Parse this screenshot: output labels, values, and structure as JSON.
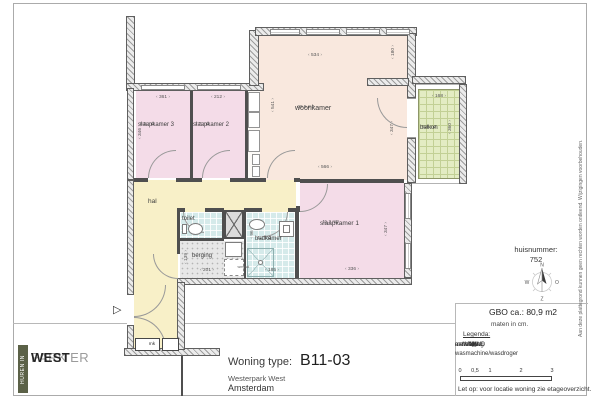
{
  "plan": {
    "rooms": {
      "woonkamer": {
        "label": "woonkamer",
        "area": "29.5 m2"
      },
      "slaapkamer1": {
        "label": "slaapkamer 1",
        "area": "11.2 m2"
      },
      "slaapkamer2": {
        "label": "slaapkamer 2",
        "area": "7.7 m2"
      },
      "slaapkamer3": {
        "label": "slaapkamer 3",
        "area": "8.5 m2"
      },
      "badkamer": {
        "label": "badkamer",
        "area": "4.1 m2"
      },
      "balkon": {
        "label": "balkon",
        "area": "5.9 m2"
      },
      "hal": {
        "label": "hal"
      },
      "toilet": {
        "label": "toilet"
      },
      "berging": {
        "label": "berging"
      },
      "meterkast": {
        "label": "mk"
      },
      "wasmachine": {
        "label": "wm/wd"
      }
    },
    "dims": {
      "sk3_top": "361",
      "sk3_left": "346",
      "sk2_top": "212",
      "woon_top": "534",
      "woon_left": "541",
      "woon_right_upper": "180",
      "woon_right_lower": "347",
      "woon_bottom": "566",
      "balkon_top": "168",
      "balkon_right": "360",
      "sk1_bottom": "336",
      "sk1_right": "347",
      "berging_width": "201",
      "berging_height": "139",
      "badkamer_bottom": "185",
      "badkamer_left": "96"
    },
    "entree_symbol": "▷",
    "compass": {
      "n": "N",
      "e": "O",
      "s": "Z",
      "w": "W"
    }
  },
  "info_panel": {
    "huisnummer_label": "huisnummer:",
    "huisnummer_value": "752",
    "gbo": "GBO ca.:  80,9 m2",
    "units_note": "maten in cm.",
    "legend_title": "Legenda:",
    "legend": [
      {
        "symbol": "WM/WD",
        "label": "aansluiting wasmachine/wasdroger"
      },
      {
        "symbol": "MK",
        "label": "meterkast"
      },
      {
        "symbol": "△",
        "label": "entree"
      }
    ],
    "scale_labels": [
      "0",
      "0,5",
      "1",
      "2",
      "3"
    ],
    "note": "Let op:  voor locatie woning zie etageoverzicht."
  },
  "footer": {
    "woning_type_label": "Woning type:",
    "woning_type_value": "B11-03",
    "project": "Westerpark West",
    "city": "Amsterdam"
  },
  "logo": {
    "vertical": "HUREN IN",
    "line1": "WESTER",
    "line2": "PARK",
    "line3": "WEST"
  },
  "disclaimer": "Aan deze plattegrond kunnen geen rechten worden ontleend. Wijzigingen voorbehouden.",
  "colors": {
    "bedroom_pink": "#f4dce8",
    "living_peach": "#f9e8de",
    "hall_yellow": "#f8f0c8",
    "wet_teal": "#d5eaea",
    "storage_gray": "#e7e7e7",
    "balcony_green": "#e3ecc3",
    "wall_dark": "#4f4f4f",
    "logo_olive": "#5b6147"
  }
}
